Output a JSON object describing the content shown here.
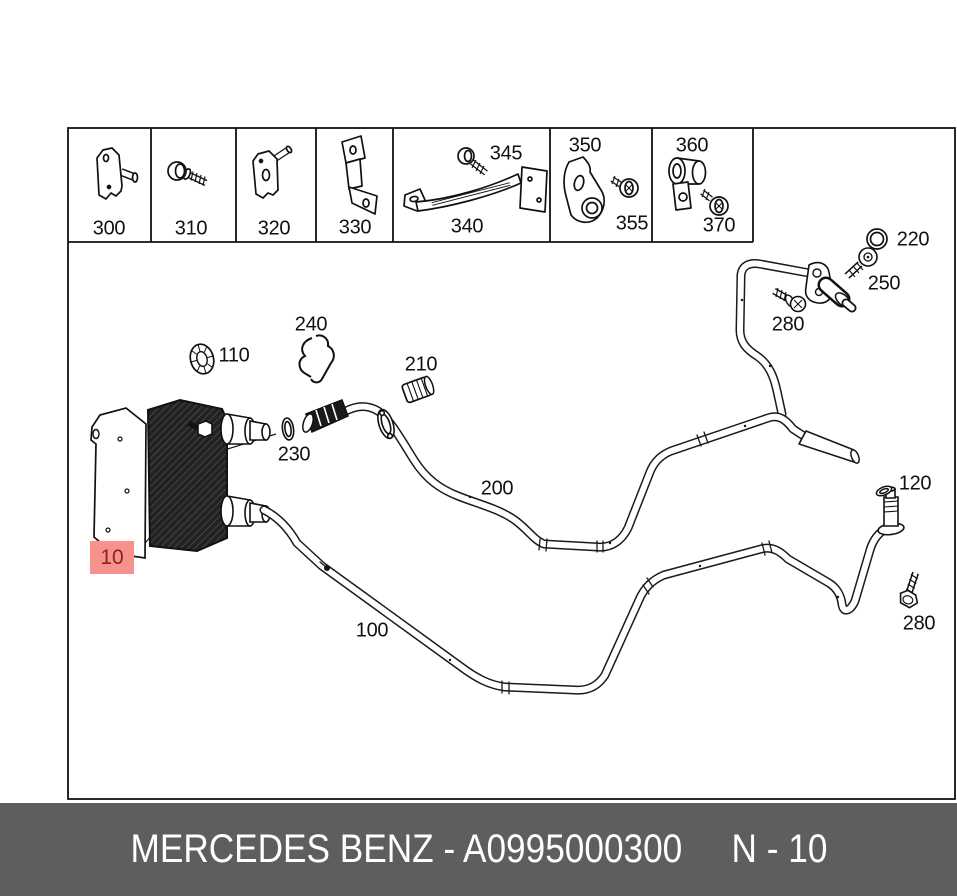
{
  "diagram": {
    "strip": {
      "labels": {
        "c300": "300",
        "c310": "310",
        "c320": "320",
        "c330": "330",
        "c340": "340",
        "c345": "345",
        "c350": "350",
        "c355": "355",
        "c360": "360",
        "c370": "370"
      }
    },
    "callouts": {
      "c100": "100",
      "c110": "110",
      "c120": "120",
      "c200": "200",
      "c210": "210",
      "c220": "220",
      "c230": "230",
      "c240": "240",
      "c250": "250",
      "c280_top": "280",
      "c280_bottom": "280"
    },
    "highlight": {
      "label": "10",
      "bg": "#f6918c",
      "text_color": "#8e211b"
    },
    "line_color": "#1a1a1a"
  },
  "footer": {
    "brand_part": "MERCEDES BENZ - A0995000300",
    "sheet_ref": "N - 10",
    "bg": "#5e5e5e",
    "text_color": "#ffffff"
  }
}
